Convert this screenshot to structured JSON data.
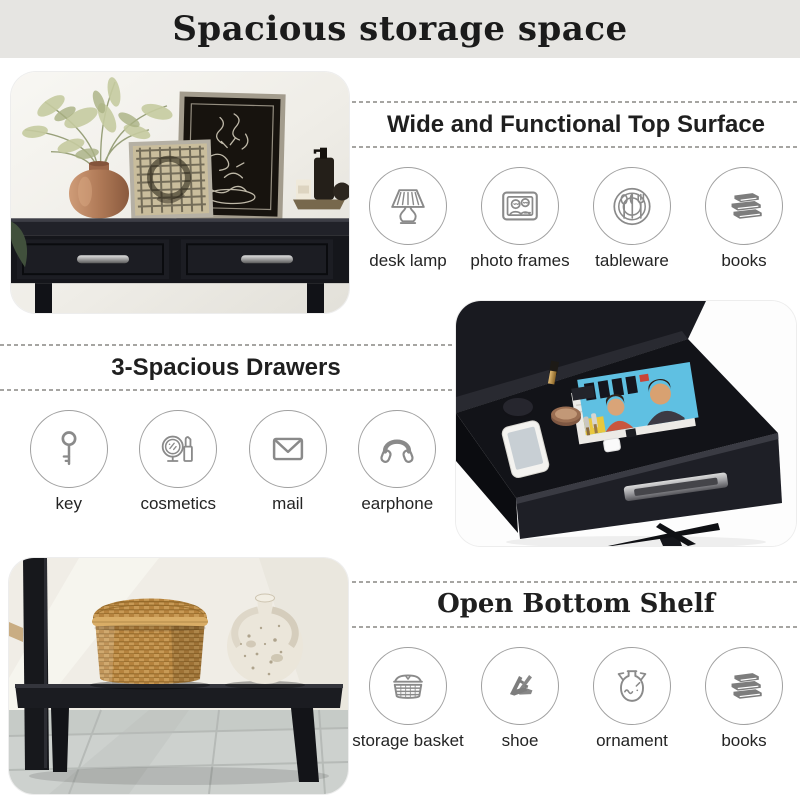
{
  "title": "Spacious storage space",
  "sections": {
    "top_surface": {
      "heading": "Wide and Functional Top Surface",
      "items": [
        {
          "icon": "desk-lamp-icon",
          "label": "desk lamp"
        },
        {
          "icon": "photo-frames-icon",
          "label": "photo frames"
        },
        {
          "icon": "tableware-icon",
          "label": "tableware"
        },
        {
          "icon": "books-icon",
          "label": "books"
        }
      ]
    },
    "drawers": {
      "heading": "3-Spacious Drawers",
      "items": [
        {
          "icon": "key-icon",
          "label": "key"
        },
        {
          "icon": "cosmetics-icon",
          "label": "cosmetics"
        },
        {
          "icon": "mail-icon",
          "label": "mail"
        },
        {
          "icon": "earphone-icon",
          "label": "earphone"
        }
      ]
    },
    "bottom_shelf": {
      "heading": "Open Bottom Shelf",
      "items": [
        {
          "icon": "storage-basket-icon",
          "label": "storage basket"
        },
        {
          "icon": "shoe-icon",
          "label": "shoe"
        },
        {
          "icon": "ornament-icon",
          "label": "ornament"
        },
        {
          "icon": "books-icon",
          "label": "books"
        }
      ]
    }
  },
  "photos": {
    "top": "console-table-top-photo",
    "drawer": "open-drawer-photo",
    "shelf": "open-bottom-shelf-photo"
  },
  "colors": {
    "title_bar_bg": "#e6e5e2",
    "heading_text": "#1f1f1f",
    "icon_stroke": "#8a8a8a",
    "circle_border": "#a0a0a0",
    "label_text": "#242424",
    "dashed_line": "#a6a5a2"
  }
}
